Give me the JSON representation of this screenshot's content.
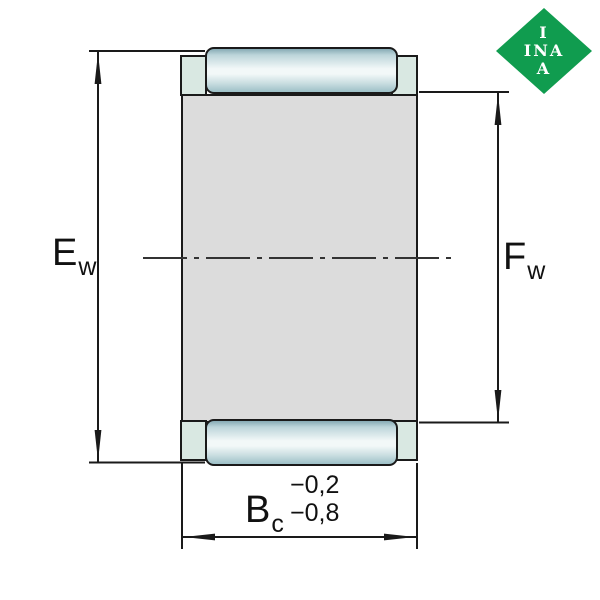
{
  "drawing_labels": {
    "ew": {
      "main": "E",
      "sub": "w"
    },
    "fw": {
      "main": "F",
      "sub": "w"
    },
    "bc": {
      "main": "B",
      "sub": "c",
      "tolerance_upper": "−0,2",
      "tolerance_lower": "−0,8"
    }
  },
  "logo": {
    "line1": "I",
    "line2": "INA",
    "line3": "A"
  },
  "colors": {
    "logo_green": "#109C4F",
    "body_gray": "#DCDCDC",
    "tab_teal": "#D9E8E2",
    "roller_edge_top": "#86ABB5",
    "roller_mid": "#F2F8F8",
    "roller_edge_bottom": "#9DC0C7",
    "line_color": "#1A1A1A"
  }
}
